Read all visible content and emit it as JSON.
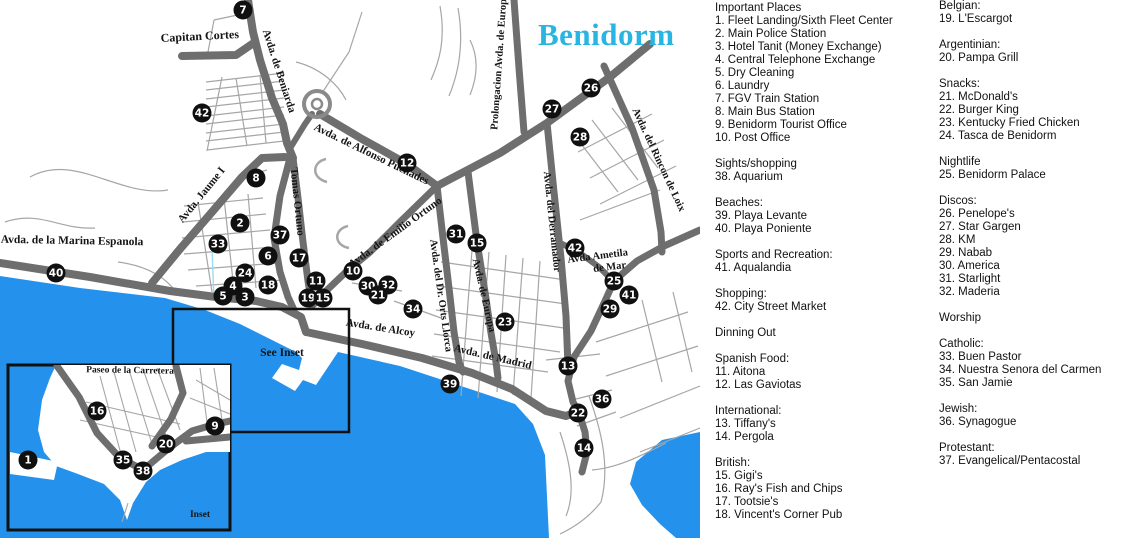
{
  "title": "Benidorm",
  "colors": {
    "sea": "#2492ec",
    "road": "#6e6e6e",
    "street": "#a6a6a6",
    "marker": "#101010",
    "title": "#29b5e2"
  },
  "map": {
    "see_inset_label": "See Inset",
    "inset_label": "Inset",
    "road_labels": [
      {
        "text": "Capitan Cortes",
        "x": 200,
        "y": 40,
        "rot": -3,
        "size": 12
      },
      {
        "text": "Avda. de Beniarda",
        "x": 276,
        "y": 72,
        "rot": 72,
        "size": 11
      },
      {
        "text": "Avda. Jaume I",
        "x": 204,
        "y": 197,
        "rot": -51,
        "size": 11
      },
      {
        "text": "Tomas Ortuno",
        "x": 294,
        "y": 202,
        "rot": 84,
        "size": 11
      },
      {
        "text": "Avda. de Alfonso Puchades",
        "x": 370,
        "y": 157,
        "rot": 26,
        "size": 11
      },
      {
        "text": "Avda. de Emilio Ortuno",
        "x": 397,
        "y": 235,
        "rot": -36,
        "size": 11
      },
      {
        "text": "Avda. del Dr. Orts Llorca",
        "x": 438,
        "y": 296,
        "rot": 82,
        "size": 10.5
      },
      {
        "text": "Avda. de Europa",
        "x": 481,
        "y": 296,
        "rot": 77,
        "size": 10.5
      },
      {
        "text": "Prolongacion Avda. de Europa",
        "x": 502,
        "y": 62,
        "rot": -86,
        "size": 10.5
      },
      {
        "text": "Avda. del Derramador",
        "x": 549,
        "y": 222,
        "rot": 84,
        "size": 10.5
      },
      {
        "text": "Avda. del Rincon de Loix",
        "x": 656,
        "y": 161,
        "rot": 65,
        "size": 10.5
      },
      {
        "text": "Avda Ametila",
        "x": 598,
        "y": 259,
        "rot": -7,
        "size": 10.5
      },
      {
        "text": "de Mar",
        "x": 610,
        "y": 270,
        "rot": -7,
        "size": 10.5
      },
      {
        "text": "Avda. de Alcoy",
        "x": 380,
        "y": 331,
        "rot": 9,
        "size": 11
      },
      {
        "text": "Avda. de Madrid",
        "x": 492,
        "y": 360,
        "rot": 13,
        "size": 11
      },
      {
        "text": "Avda. de la Marina Espanola",
        "x": 72,
        "y": 244,
        "rot": 1,
        "size": 11.5
      },
      {
        "text": "Paseo de la Carretera",
        "x": 130,
        "y": 373,
        "rot": 1,
        "size": 9.5
      }
    ],
    "markers": [
      {
        "n": "7",
        "x": 243,
        "y": 10
      },
      {
        "n": "42",
        "x": 202,
        "y": 113
      },
      {
        "n": "12",
        "x": 407,
        "y": 163
      },
      {
        "n": "8",
        "x": 256,
        "y": 178
      },
      {
        "n": "2",
        "x": 240,
        "y": 223
      },
      {
        "n": "37",
        "x": 280,
        "y": 235
      },
      {
        "n": "33",
        "x": 218,
        "y": 244
      },
      {
        "n": "6",
        "x": 268,
        "y": 256
      },
      {
        "n": "17",
        "x": 299,
        "y": 258
      },
      {
        "n": "24",
        "x": 245,
        "y": 273
      },
      {
        "n": "10",
        "x": 353,
        "y": 271
      },
      {
        "n": "11",
        "x": 316,
        "y": 281
      },
      {
        "n": "18",
        "x": 268,
        "y": 285
      },
      {
        "n": "30",
        "x": 368,
        "y": 286
      },
      {
        "n": "32",
        "x": 388,
        "y": 285
      },
      {
        "n": "4",
        "x": 233,
        "y": 286
      },
      {
        "n": "21",
        "x": 378,
        "y": 295
      },
      {
        "n": "5",
        "x": 223,
        "y": 296
      },
      {
        "n": "3",
        "x": 245,
        "y": 297
      },
      {
        "n": "19",
        "x": 308,
        "y": 298
      },
      {
        "n": "15",
        "x": 323,
        "y": 298
      },
      {
        "n": "34",
        "x": 413,
        "y": 309
      },
      {
        "n": "31",
        "x": 456,
        "y": 234
      },
      {
        "n": "15",
        "x": 477,
        "y": 243
      },
      {
        "n": "26",
        "x": 591,
        "y": 88
      },
      {
        "n": "27",
        "x": 552,
        "y": 109
      },
      {
        "n": "28",
        "x": 580,
        "y": 137
      },
      {
        "n": "42",
        "x": 575,
        "y": 248
      },
      {
        "n": "25",
        "x": 614,
        "y": 281
      },
      {
        "n": "41",
        "x": 629,
        "y": 295
      },
      {
        "n": "29",
        "x": 610,
        "y": 309
      },
      {
        "n": "23",
        "x": 505,
        "y": 322
      },
      {
        "n": "13",
        "x": 568,
        "y": 366
      },
      {
        "n": "39",
        "x": 450,
        "y": 384
      },
      {
        "n": "36",
        "x": 602,
        "y": 399
      },
      {
        "n": "22",
        "x": 578,
        "y": 413
      },
      {
        "n": "14",
        "x": 584,
        "y": 448
      },
      {
        "n": "40",
        "x": 56,
        "y": 273
      },
      {
        "n": "16",
        "x": 97,
        "y": 411
      },
      {
        "n": "9",
        "x": 215,
        "y": 426
      },
      {
        "n": "20",
        "x": 166,
        "y": 444
      },
      {
        "n": "1",
        "x": 28,
        "y": 460
      },
      {
        "n": "35",
        "x": 123,
        "y": 460
      },
      {
        "n": "38",
        "x": 143,
        "y": 471
      }
    ]
  },
  "legend": {
    "columns": [
      {
        "sections": [
          {
            "heading": "Important Places",
            "items": [
              {
                "num": "1",
                "name": "Fleet Landing/Sixth Fleet Center"
              },
              {
                "num": "2",
                "name": "Main Police Station"
              },
              {
                "num": "3",
                "name": "Hotel Tanit (Money Exchange)"
              },
              {
                "num": "4",
                "name": "Central Telephone Exchange"
              },
              {
                "num": "5",
                "name": "Dry Cleaning"
              },
              {
                "num": "6",
                "name": "Laundry"
              },
              {
                "num": "7",
                "name": "FGV Train Station"
              },
              {
                "num": "8",
                "name": "Main Bus Station"
              },
              {
                "num": "9",
                "name": "Benidorm Tourist Office"
              },
              {
                "num": "10",
                "name": "Post Office"
              }
            ]
          },
          {
            "heading": "Sights/shopping",
            "items": [
              {
                "num": "38",
                "name": "Aquarium"
              }
            ]
          },
          {
            "heading": "Beaches:",
            "items": [
              {
                "num": "39",
                "name": "Playa Levante"
              },
              {
                "num": "40",
                "name": "Playa Poniente"
              }
            ]
          },
          {
            "heading": "Sports and Recreation:",
            "items": [
              {
                "num": "41",
                "name": "Aqualandia"
              }
            ]
          },
          {
            "heading": "Shopping:",
            "items": [
              {
                "num": "42",
                "name": "City Street Market"
              }
            ]
          },
          {
            "heading": "Dinning Out",
            "items": []
          },
          {
            "heading": "Spanish Food:",
            "items": [
              {
                "num": "11",
                "name": "Aitona"
              },
              {
                "num": "12",
                "name": "Las Gaviotas"
              }
            ]
          },
          {
            "heading": "International:",
            "items": [
              {
                "num": "13",
                "name": "Tiffany's"
              },
              {
                "num": "14",
                "name": "Pergola"
              }
            ]
          },
          {
            "heading": "British:",
            "items": [
              {
                "num": "15",
                "name": "Gigi's"
              },
              {
                "num": "16",
                "name": "Ray's Fish and Chips"
              },
              {
                "num": "17",
                "name": "Tootsie's"
              },
              {
                "num": "18",
                "name": "Vincent's Corner Pub"
              }
            ]
          }
        ]
      },
      {
        "sections": [
          {
            "heading": "Belgian:",
            "items": [
              {
                "num": "19",
                "name": "L'Escargot"
              }
            ]
          },
          {
            "heading": "Argentinian:",
            "items": [
              {
                "num": "20",
                "name": "Pampa Grill"
              }
            ]
          },
          {
            "heading": "Snacks:",
            "items": [
              {
                "num": "21",
                "name": "McDonald's"
              },
              {
                "num": "22",
                "name": "Burger King"
              },
              {
                "num": "23",
                "name": "Kentucky Fried Chicken"
              },
              {
                "num": "24",
                "name": "Tasca de Benidorm"
              }
            ]
          },
          {
            "heading": "Nightlife",
            "items": [
              {
                "num": "25",
                "name": "Benidorm Palace"
              }
            ]
          },
          {
            "heading": "Discos:",
            "items": [
              {
                "num": "26",
                "name": "Penelope's"
              },
              {
                "num": "27",
                "name": "Star Gargen"
              },
              {
                "num": "28",
                "name": "KM"
              },
              {
                "num": "29",
                "name": "Nabab"
              },
              {
                "num": "30",
                "name": "America"
              },
              {
                "num": "31",
                "name": "Starlight"
              },
              {
                "num": "32",
                "name": "Maderia"
              }
            ]
          },
          {
            "heading": "Worship",
            "items": []
          },
          {
            "heading": "Catholic:",
            "items": [
              {
                "num": "33",
                "name": "Buen Pastor"
              },
              {
                "num": "34",
                "name": "Nuestra Senora del Carmen"
              },
              {
                "num": "35",
                "name": "San Jamie"
              }
            ]
          },
          {
            "heading": "Jewish:",
            "items": [
              {
                "num": "36",
                "name": "Synagogue"
              }
            ]
          },
          {
            "heading": "Protestant:",
            "items": [
              {
                "num": "37",
                "name": "Evangelical/Pentacostal"
              }
            ]
          }
        ]
      }
    ]
  }
}
